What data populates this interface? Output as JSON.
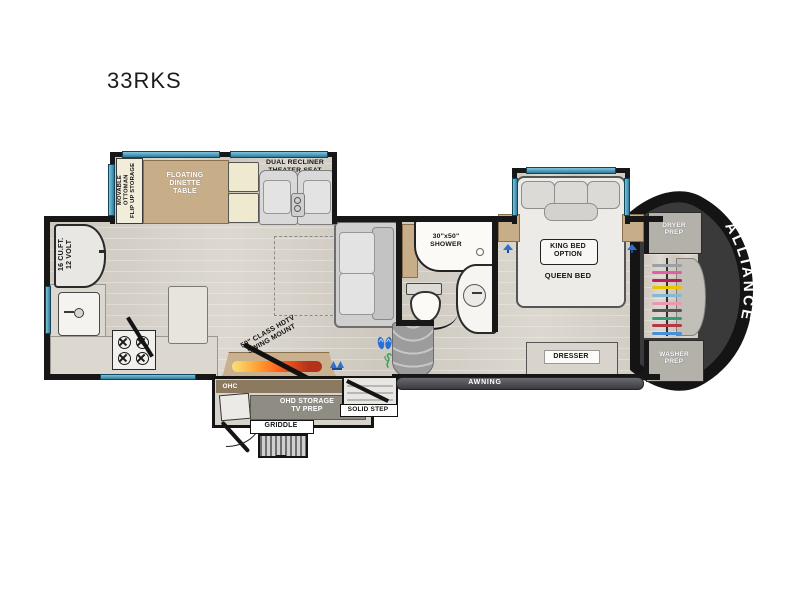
{
  "title": "33RKS",
  "brand": "ALLIANCE",
  "living": {
    "ottoman": "MOVABLE OTTOMAN\nFLIP UP STORAGE",
    "dinette": "FLOATING\nDINETTE\nTABLE",
    "theater": "DUAL RECLINER THEATER SEAT",
    "tv_mount": "50\" CLASS HDTV\nSWING MOUNT"
  },
  "kitchen": {
    "fridge": "16 CU.FT.\n12 VOLT"
  },
  "bath": {
    "shower": "30\"x50\"\nSHOWER"
  },
  "bedroom": {
    "king_option": "KING BED\nOPTION",
    "queen_bed": "QUEEN BED",
    "dresser": "DRESSER"
  },
  "front_cap": {
    "dryer_prep": "DRYER\nPREP",
    "washer_prep": "WASHER\nPREP",
    "hanger_colors": [
      "#9aa0a6",
      "#e35fa4",
      "#c2185b",
      "#e8c400",
      "#86b8d4",
      "#e899b0",
      "#555555",
      "#2e9e74",
      "#b23a48",
      "#4a90d9"
    ]
  },
  "exterior": {
    "ohc_left": "OHC",
    "ohc_right": "OHC",
    "ohd_storage": "OHD STORAGE\nTV PREP",
    "griddle": "GRIDDLE",
    "solid_step": "SOLID STEP",
    "awning": "AWNING"
  },
  "colors": {
    "wall": "#171717",
    "window": "#2f86a6",
    "flame_accent": "#e8541e",
    "awning_bar": "#4c4c50"
  }
}
